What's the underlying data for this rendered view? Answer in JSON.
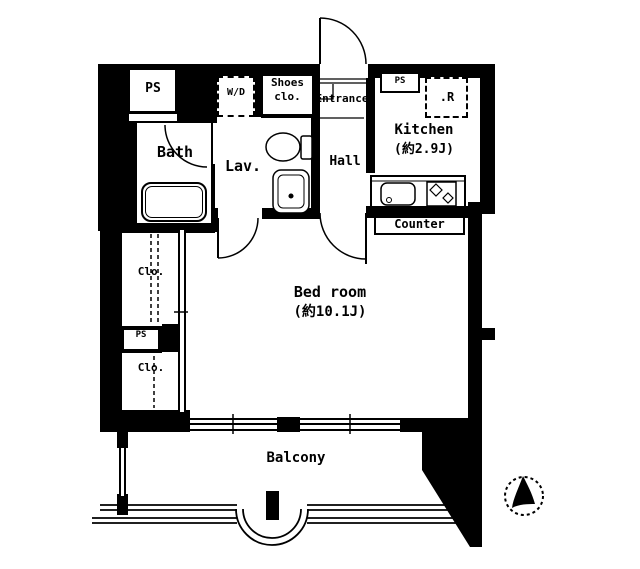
{
  "meta": {
    "title": "Japanese apartment floor plan (1K layout)",
    "ink_color": "#000000",
    "bg_color": "#ffffff"
  },
  "rooms": {
    "ps_top": {
      "label": "PS"
    },
    "bath": {
      "label": "Bath"
    },
    "washer_dryer": {
      "label": "W/D"
    },
    "shoes_closet": {
      "label_line1": "Shoes",
      "label_line2": "clo."
    },
    "entrance": {
      "label": "Entrance"
    },
    "ps_kitchen": {
      "label": "PS"
    },
    "refrigerator": {
      "label": ".R"
    },
    "kitchen": {
      "label": "Kitchen",
      "size_label": "(約2.9J)"
    },
    "hall": {
      "label": "Hall"
    },
    "lavatory": {
      "label": "Lav."
    },
    "counter": {
      "label": "Counter"
    },
    "closet_upper": {
      "label": "Clo."
    },
    "ps_middle": {
      "label": "PS"
    },
    "closet_lower": {
      "label": "Clo."
    },
    "bedroom": {
      "label": "Bed room",
      "size_label": "(約10.1J)"
    },
    "balcony": {
      "label": "Balcony"
    }
  },
  "icons": {
    "compass": "north-arrow-compass"
  }
}
